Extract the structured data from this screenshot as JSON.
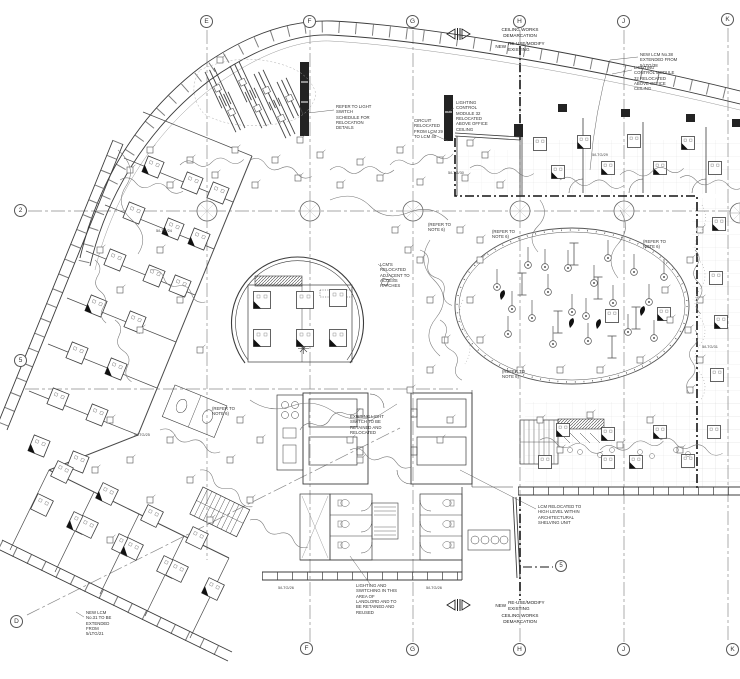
{
  "drawing": {
    "type": "ceiling-works-lighting-layout-plan"
  },
  "grid": {
    "top": [
      "E",
      "F",
      "G",
      "H",
      "J",
      "K"
    ],
    "bottom": [
      "F",
      "G",
      "H",
      "J",
      "K"
    ],
    "left": [
      "2",
      "5",
      "D"
    ],
    "section_marker": "5"
  },
  "demarcation": {
    "title_line1": "CEILING WORKS",
    "title_line2": "DEMARCATION",
    "new_label": "NEW",
    "reuse_label": "RE-USE/MODIFY",
    "existing_label": "EXISTING"
  },
  "notes": {
    "switch_schedule": "REFER TO LIGHT SWITCH SCHEDULE FOR RELOCATION DETAILS",
    "circuit_relocated": "CIRCUIT RELOCATED FROM LCM 29 TO LCM 40",
    "lcm_office_left": "LIGHTING CONTROL MODULE 32 RELOCATED ABOVE OFFICE CEILING",
    "new_lcm_extended": "NEW LCM No.38 EXTENDED FROM 5/LTG/38",
    "lcm_office_right": "LIGHTING CONTROL MODULE 32 RELOCATED ABOVE OFFICE CEILING",
    "lcms_hatches": "LCM'S RELOCATED ADJACENT TO ACCESS HATCHES",
    "refer_note6": "(REFER TO NOTE 6)",
    "existing_switch": "EXISTING LIGHT SWITCH TO BE RETAINED AND RELOCATED",
    "landlord": "LIGHTING AND SWITCHING IN THIS AREA OF LANDLORD AND TO BE RETAINED AND REUSED",
    "lcm_shelving": "LCM RELOCATED TO HIGH LEVEL WITHIN ARCHITECTURAL SHELVING UNIT",
    "new_lcm31": "NEW LCM No.31 TO BE EXTENDED FROM 5/LTG/21"
  },
  "circuit_labels": {
    "a": "5/LTG/29",
    "b": "5/LTG/26",
    "c": "5/LTG/26",
    "d": "5/LTG/24",
    "e": "5/LTG/31",
    "f": "5/LTG/25",
    "g": "5/LTG/30"
  },
  "colors": {
    "wall": "#3c3c3c",
    "heavy_demarcation": "#141414",
    "grid_line": "#8a8a8a",
    "faint_grid": "#d9d9d9",
    "emergency_fill": "#111111"
  }
}
